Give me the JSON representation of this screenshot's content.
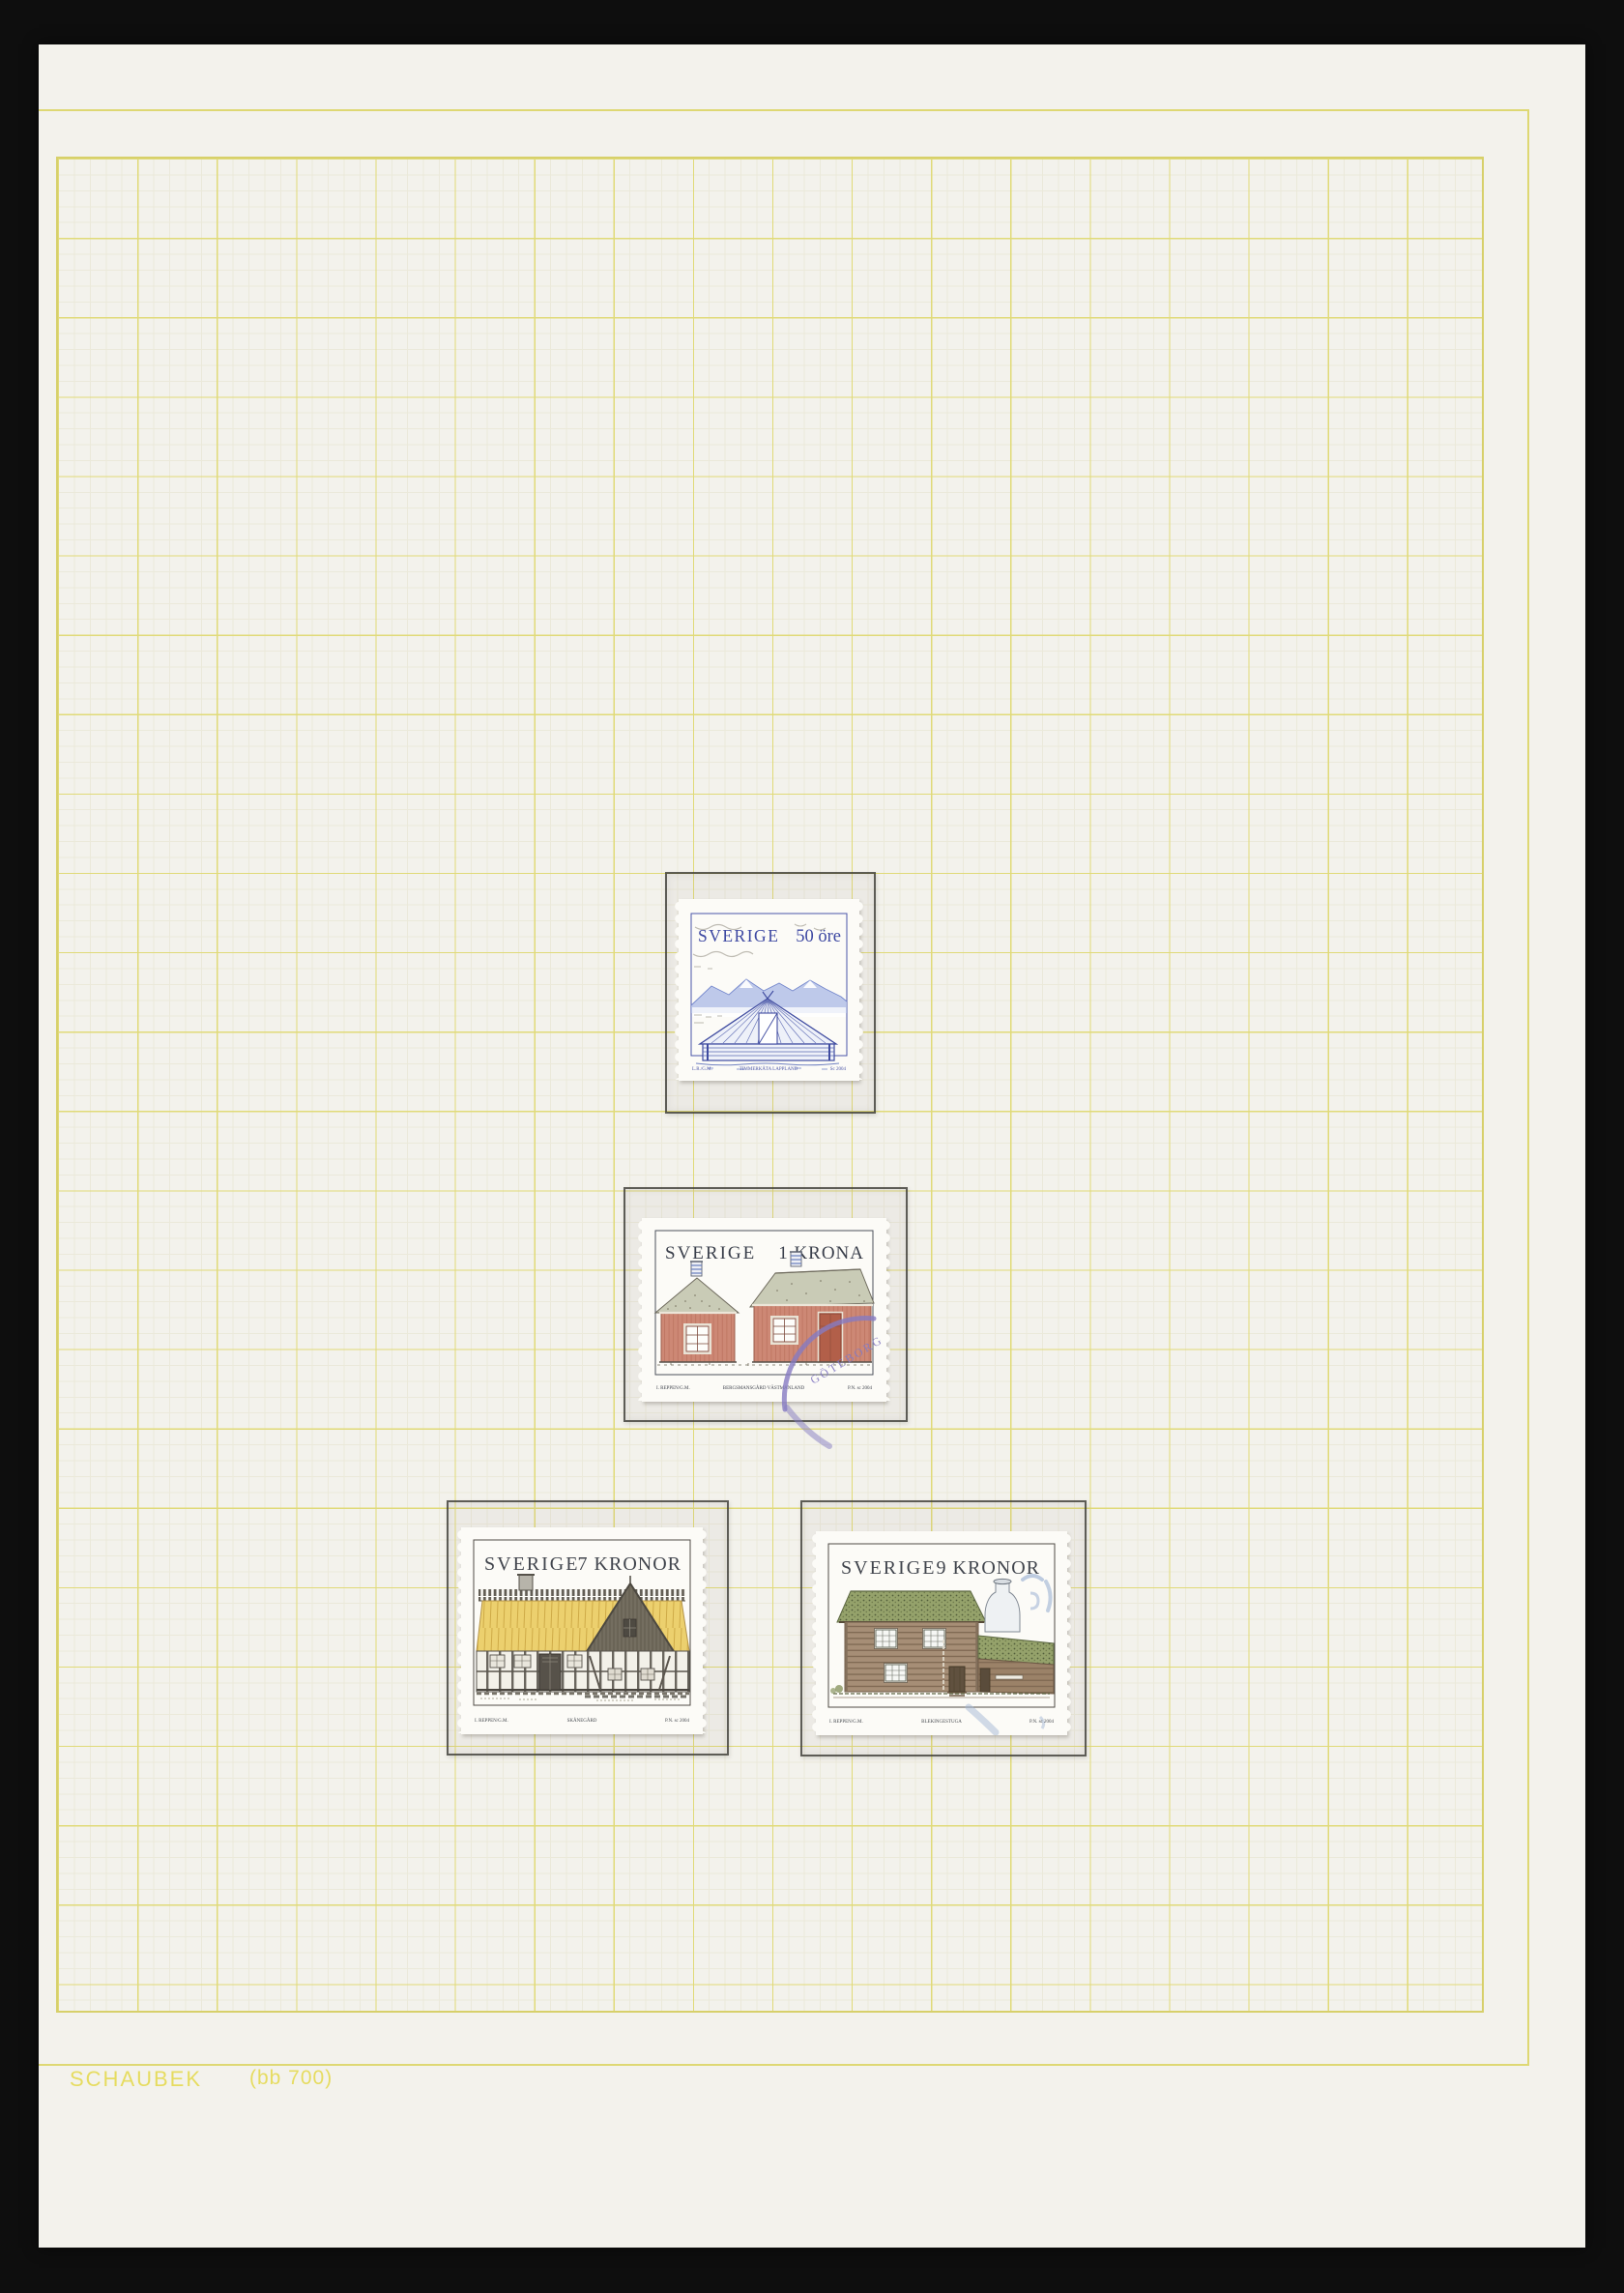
{
  "album_page": {
    "brand": "SCHAUBEK",
    "page_code": "(bb 700)"
  },
  "stamps": [
    {
      "country": "SVERIGE",
      "value": "50 öre",
      "caption": "TIMMERKÅTA LAPPLAND",
      "credit_left": "L.R./G.M.",
      "credit_right": "Sc 2004"
    },
    {
      "country": "SVERIGE",
      "value": "1 KRONA",
      "caption": "BERGSMANSGÅRD VÄSTMANLAND",
      "credit_left": "I. REPPEN/G.M.",
      "credit_right": "P.N. sc 2004",
      "cancel_text": "GÖTEBORG"
    },
    {
      "country": "SVERIGE",
      "value": "7 KRONOR",
      "caption": "SKÅNEGÅRD",
      "credit_left": "I. REPPEN/G.M.",
      "credit_right": "P.N. sc 2004"
    },
    {
      "country": "SVERIGE",
      "value": "9 KRONOR",
      "caption": "BLEKINGESTUGA",
      "credit_left": "I. REPPEN/G.M.",
      "credit_right": "P.N. sc 2004"
    }
  ],
  "colors": {
    "background": "#0e0e0e",
    "page": "#f3f2ec",
    "grid_major": "#e0da78",
    "grid_fine": "#ebe9da",
    "brand_yellow": "#e6dc60",
    "stamp1_blue": "#3d48a2",
    "stamp_title_gray": "#3a3f4b",
    "falu_red": "#cd8875",
    "thatch_yellow": "#ecd06e",
    "sod_green": "#95a26b",
    "log_brown": "#a68e76",
    "cancel_purple": "#867bc2",
    "cancel_blue": "#a3b7d6"
  }
}
